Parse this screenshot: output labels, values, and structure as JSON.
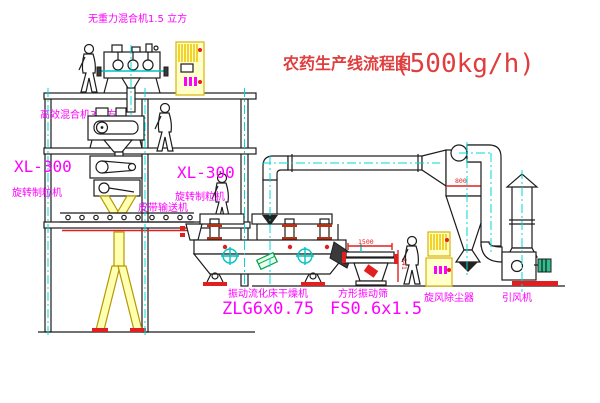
{
  "title": {
    "text": "农药生产线流程图",
    "capacity": "(500kg/h)"
  },
  "labels": {
    "top_mixer": "无重力混合机1.5 立方",
    "floor2_mixer": "高效混合机3立方",
    "granulator1_model": "XL-300",
    "granulator1_name": "旋转制粒机",
    "granulator2_model": "XL-300",
    "granulator2_name": "旋转制粒机",
    "belt_conveyor": "皮带输送机",
    "dryer_name": "振动流化床干燥机",
    "dryer_model": "ZLG6x0.75",
    "sieve_name": "方形振动筛",
    "sieve_model": "FS0.6x1.5",
    "cyclone": "旋风除尘器",
    "fan": "引风机"
  },
  "dimensions": {
    "sieve_length": "1500",
    "sieve_height": "541",
    "cyclone_diameter": "800"
  },
  "colors": {
    "label_magenta": "#ff00ff",
    "title_red": "#e03e3e",
    "dimension_red": "#dd2222",
    "equipment_yellow": "#f0c800",
    "centerline_cyan": "#00d8d8",
    "line_black": "#1c1c1c",
    "accent_red": "#e02020",
    "accent_green": "#00a050"
  }
}
